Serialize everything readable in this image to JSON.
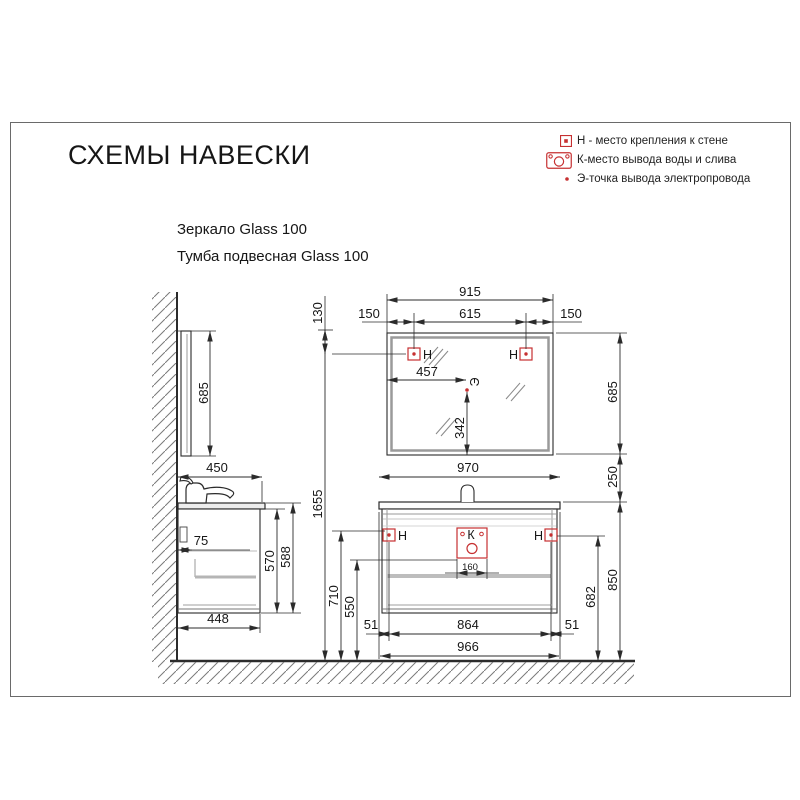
{
  "page": {
    "title": "СХЕМЫ НАВЕСКИ"
  },
  "legend": {
    "h": "Н - место крепления к стене",
    "k": "К-место вывода воды и слива",
    "e": "Э-точка вывода электропровода"
  },
  "products": {
    "mirror": "Зеркало Glass 100",
    "vanity": "Тумба подвесная Glass 100"
  },
  "markers": {
    "h": "Н",
    "k": "К",
    "e": "Э"
  },
  "colors": {
    "marker_red": "#c63031",
    "line": "#2b2b2b"
  },
  "dims": {
    "d915": "915",
    "d150_left": "150",
    "d615": "615",
    "d150_right": "150",
    "d130": "130",
    "d685_side": "685",
    "d685_front": "685",
    "d457": "457",
    "d342": "342",
    "d450": "450",
    "d75": "75",
    "d570": "570",
    "d588": "588",
    "d448": "448",
    "d1655": "1655",
    "d710": "710",
    "d550": "550",
    "d970": "970",
    "d250": "250",
    "d160": "160",
    "d51_left": "51",
    "d864": "864",
    "d51_right": "51",
    "d966": "966",
    "d682": "682",
    "d850": "850"
  }
}
